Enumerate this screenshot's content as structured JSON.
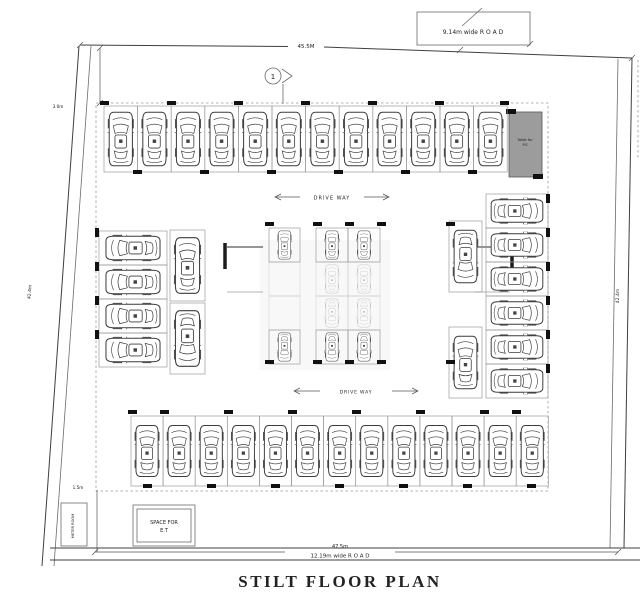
{
  "title": "STILT FLOOR PLAN",
  "labels": {
    "dim_top": "45.5M",
    "road_top": "9.14m wide R O A D",
    "road_bottom": "12.19m wide R O A D",
    "dim_bottom": "47.5m",
    "dim_left": "42.4m",
    "dim_right": "42.4m",
    "dim_setback_top": "3.0m",
    "dim_setback_bottom": "1.5m",
    "driveway_upper": "DRIVE WAY",
    "driveway_lower": "DRIVE WAY",
    "section_marker": "1",
    "space_et_1": "SPACE FOR",
    "space_et_2": "E.T",
    "toilet_1": "Toilet for",
    "toilet_2": "P.S",
    "meter_room": "METER ROOM"
  },
  "colors": {
    "ink": "#3f3f3f",
    "toilet_fill": "#9c9c9c",
    "column_tick": "#111111",
    "background": "#ffffff"
  },
  "parking": {
    "rows": [
      {
        "name": "top-row",
        "x": 104,
        "y": 106,
        "dx": 33.6,
        "dy": 0,
        "count": 12,
        "sw": 33.6,
        "sh": 66,
        "orient": "up"
      },
      {
        "name": "bottom-row",
        "x": 131,
        "y": 416,
        "dx": 32.1,
        "dy": 0,
        "count": 13,
        "sw": 32.1,
        "sh": 70,
        "orient": "up"
      },
      {
        "name": "left-bay",
        "x": 99,
        "y": 231,
        "dx": 0,
        "dy": 34,
        "count": 4,
        "sw": 68,
        "sh": 34,
        "orient": "left"
      },
      {
        "name": "left-inner-top",
        "x": 170,
        "y": 230,
        "dx": 0,
        "dy": 0,
        "count": 1,
        "sw": 35,
        "sh": 71,
        "orient": "up"
      },
      {
        "name": "left-inner-bottom",
        "x": 170,
        "y": 303,
        "dx": 0,
        "dy": 0,
        "count": 1,
        "sw": 35,
        "sh": 71,
        "orient": "down"
      },
      {
        "name": "center-colA-top",
        "x": 269,
        "y": 228,
        "dx": 0,
        "dy": 0,
        "count": 1,
        "sw": 31,
        "sh": 34,
        "orient": "up"
      },
      {
        "name": "center-colA-mid1",
        "x": 269,
        "y": 262,
        "dx": 0,
        "dy": 0,
        "count": 1,
        "sw": 31,
        "sh": 34,
        "orient": "up",
        "empty": true,
        "faint": true
      },
      {
        "name": "center-colA-mid2",
        "x": 269,
        "y": 296,
        "dx": 0,
        "dy": 0,
        "count": 1,
        "sw": 31,
        "sh": 34,
        "orient": "down",
        "empty": true,
        "faint": true
      },
      {
        "name": "center-colA-bottom",
        "x": 269,
        "y": 330,
        "dx": 0,
        "dy": 0,
        "count": 1,
        "sw": 31,
        "sh": 34,
        "orient": "down"
      },
      {
        "name": "center-top",
        "x": 316,
        "y": 228,
        "dx": 32,
        "dy": 0,
        "count": 2,
        "sw": 32,
        "sh": 34,
        "orient": "up"
      },
      {
        "name": "center-mid1",
        "x": 316,
        "y": 262,
        "dx": 32,
        "dy": 0,
        "count": 2,
        "sw": 32,
        "sh": 34,
        "orient": "up",
        "faint": true
      },
      {
        "name": "center-mid2",
        "x": 316,
        "y": 296,
        "dx": 32,
        "dy": 0,
        "count": 2,
        "sw": 32,
        "sh": 34,
        "orient": "down",
        "faint": true
      },
      {
        "name": "center-bottom",
        "x": 316,
        "y": 330,
        "dx": 32,
        "dy": 0,
        "count": 2,
        "sw": 32,
        "sh": 34,
        "orient": "down"
      },
      {
        "name": "right-inner-top",
        "x": 449,
        "y": 221,
        "dx": 0,
        "dy": 0,
        "count": 1,
        "sw": 33,
        "sh": 71,
        "orient": "down"
      },
      {
        "name": "right-inner-bottom",
        "x": 449,
        "y": 327,
        "dx": 0,
        "dy": 0,
        "count": 1,
        "sw": 33,
        "sh": 71,
        "orient": "up"
      },
      {
        "name": "right-bay",
        "x": 486,
        "y": 194,
        "dx": 0,
        "dy": 34,
        "count": 6,
        "sw": 62,
        "sh": 34,
        "orient": "right"
      }
    ]
  }
}
